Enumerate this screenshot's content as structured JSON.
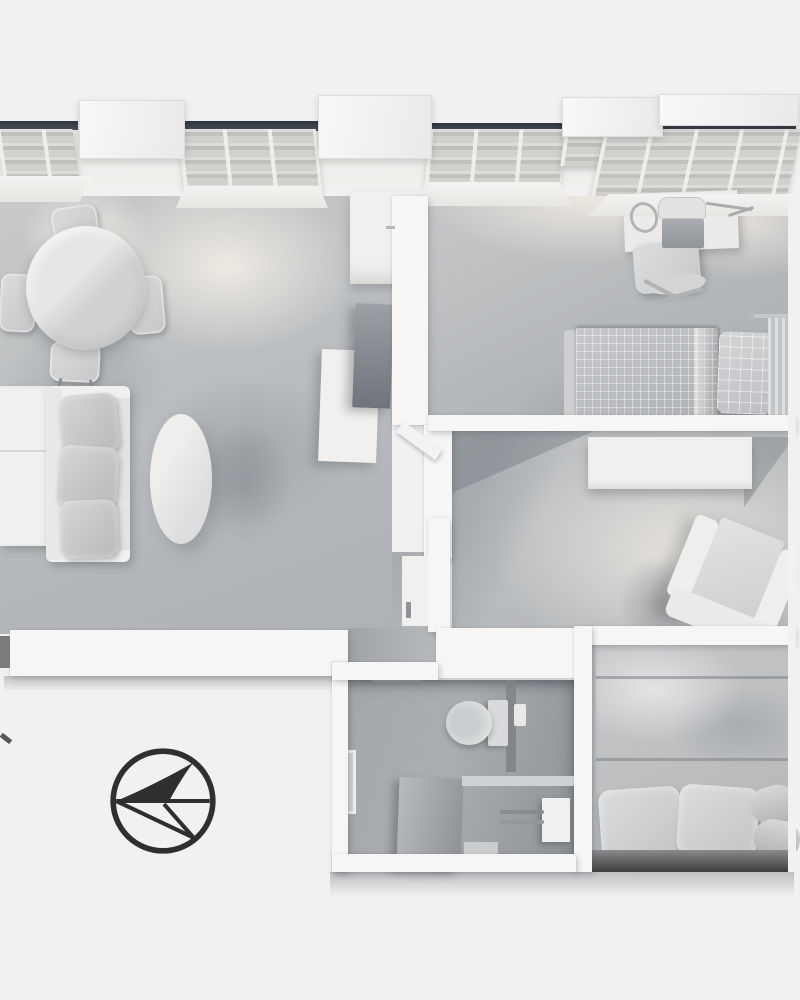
{
  "scene": {
    "title": "Apartment 3D floor plan - top-down monochrome clay render",
    "type": "architectural-visualization",
    "view": "top-down perspective",
    "palette": {
      "background": "#F1F1F2",
      "wall_white": "#F7F6F4",
      "floor_light": "#D8D5D1",
      "floor_mid": "#BFC2C5",
      "floor_dark": "#A9ADB1",
      "furniture_white": "#F1F0EE",
      "furniture_gray": "#C4C6C8",
      "bathroom_shadow": "#9A9EA2",
      "glazing_dark": "#3C434D",
      "compass_dark": "#2D2F30"
    }
  },
  "rooms": [
    {
      "id": "living-room",
      "name": "Living / dining room",
      "furniture": [
        "Round dining table",
        "Dining chair",
        "Sideboard",
        "Sofa with cushions",
        "Oval coffee table",
        "TV panel",
        "TV console",
        "Wall cabinet",
        "Open door"
      ]
    },
    {
      "id": "bedroom-1",
      "name": "Bedroom 1 (top right)",
      "furniture": [
        "Desk",
        "Laptop",
        "Desk chair",
        "Headphones",
        "Desk lamp",
        "Bed with checkered duvet",
        "Checkered pillow",
        "Curtain"
      ]
    },
    {
      "id": "bedroom-2",
      "name": "Bedroom 2 (middle right)",
      "furniture": [
        "Wardrobe",
        "Armchair"
      ]
    },
    {
      "id": "bedroom-3",
      "name": "Bedroom 3 (bottom right)",
      "furniture": [
        "Double bed with duvet",
        "Pillow left",
        "Pillow right",
        "Bolster roll"
      ]
    },
    {
      "id": "bathroom",
      "name": "Bathroom",
      "furniture": [
        "Toilet",
        "Mirror panel",
        "Partition wall",
        "Towel rail",
        "Bath mat",
        "Door plate"
      ]
    },
    {
      "id": "hallway",
      "name": "Hallway",
      "furniture": []
    }
  ],
  "windows": {
    "count": 4,
    "position": "top exterior wall",
    "features": [
      "bay blocks above wall line",
      "radiator grilles in perspective",
      "dark glazing slits"
    ]
  },
  "compass": {
    "label": "North arrow",
    "points": "left",
    "ring_color": "#2D2F30"
  }
}
